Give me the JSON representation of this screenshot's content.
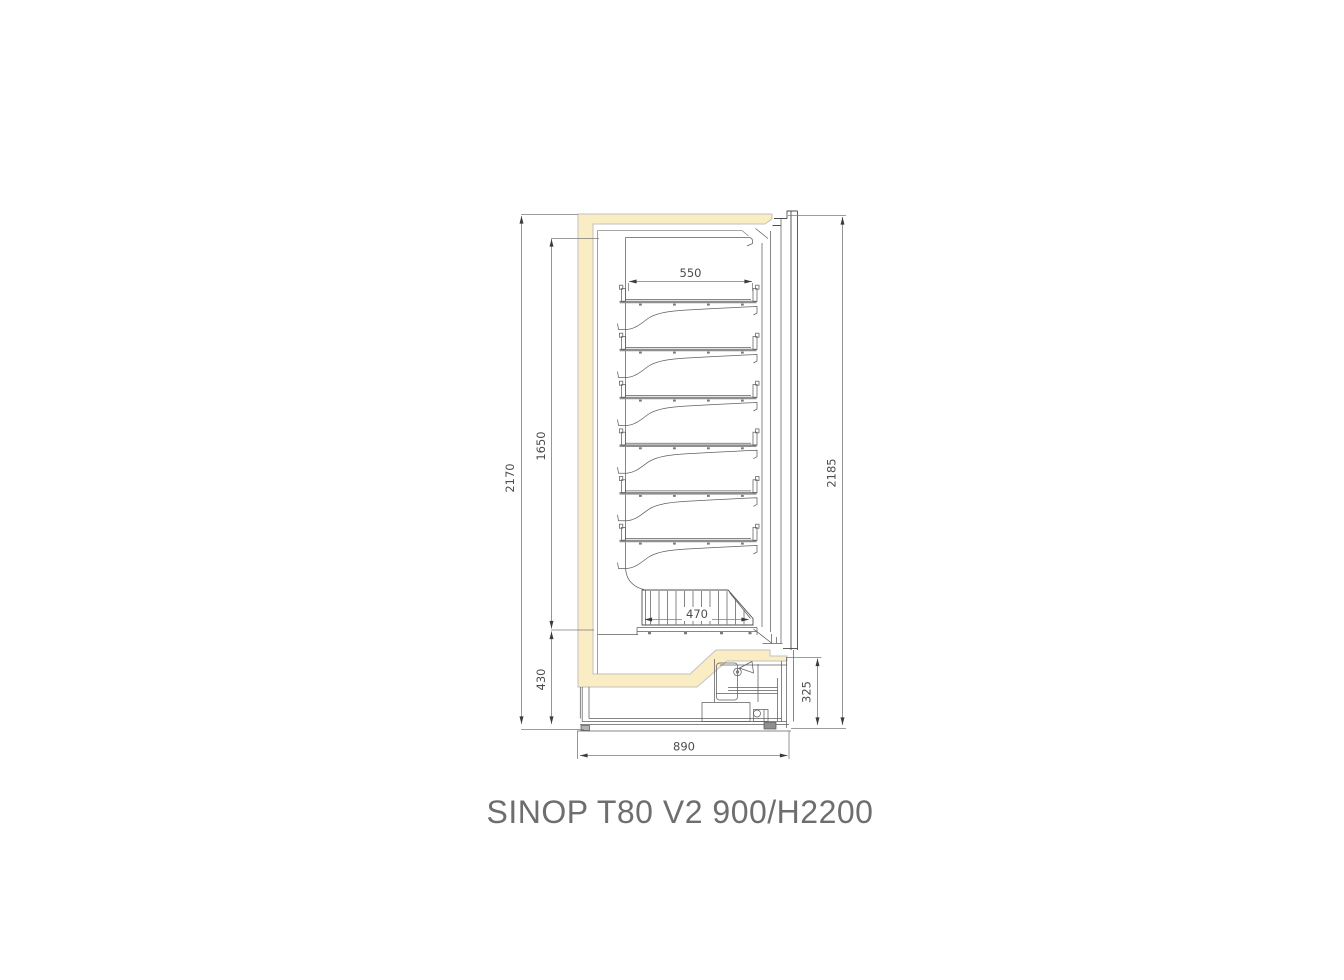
{
  "title": "SINOP T80 V2 900/H2200",
  "drawing": {
    "type": "technical-side-section",
    "shelf_count": 6,
    "dims": {
      "overall_height_left": "2170",
      "interior_height": "1650",
      "base_height": "430",
      "shelf_depth": "550",
      "basket_depth": "470",
      "overall_height_right": "2185",
      "machine_compartment_height": "325",
      "overall_depth": "890"
    },
    "colors": {
      "insulation_fill": "#FAECC3",
      "outline": "#4d4d4d",
      "dim_line": "#7c7c7c",
      "title_text": "#6e6e6e"
    }
  }
}
